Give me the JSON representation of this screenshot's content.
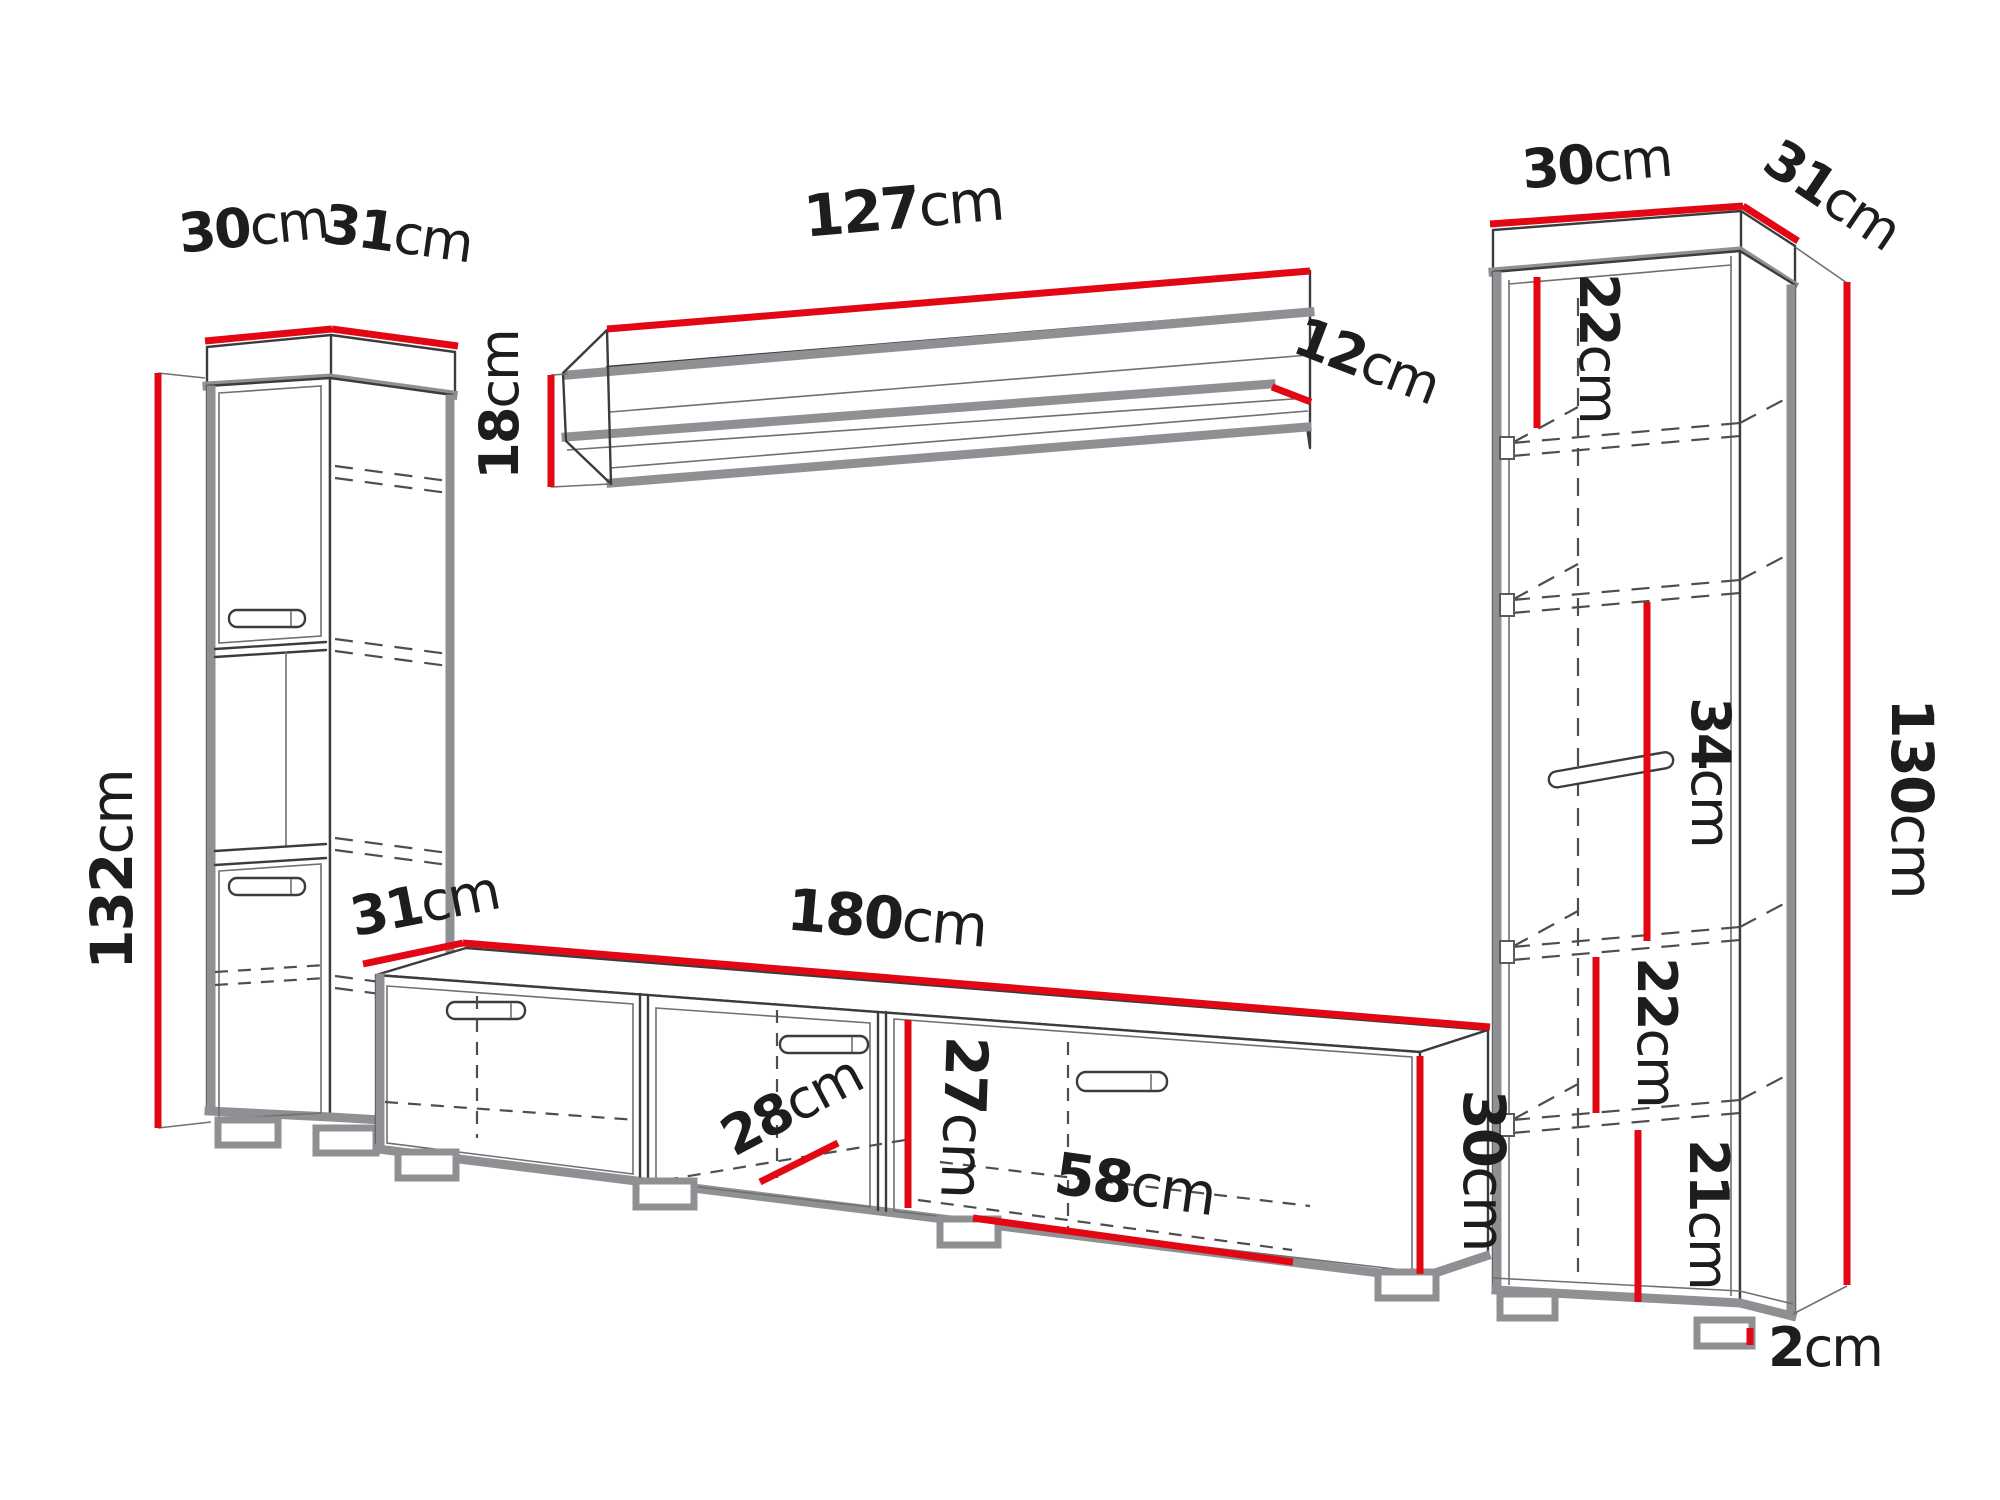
{
  "diagram": {
    "title": "wall-unit furniture dimension diagram",
    "unit": "cm",
    "colors": {
      "dimension_line": "#e30613",
      "edge_gray": "#8f9093",
      "outline": "#3c3c3c",
      "text": "#1d1d1b",
      "background": "#ffffff"
    },
    "left_cabinet": {
      "width": {
        "value": "30",
        "unit": "cm"
      },
      "depth": {
        "value": "31",
        "unit": "cm"
      },
      "height": {
        "value": "132",
        "unit": "cm"
      }
    },
    "wall_shelf": {
      "width": {
        "value": "127",
        "unit": "cm"
      },
      "height": {
        "value": "18",
        "unit": "cm"
      },
      "depth": {
        "value": "12",
        "unit": "cm"
      }
    },
    "right_cabinet": {
      "width": {
        "value": "30",
        "unit": "cm"
      },
      "depth": {
        "value": "31",
        "unit": "cm"
      },
      "height": {
        "value": "130",
        "unit": "cm"
      },
      "section_top": {
        "value": "22",
        "unit": "cm"
      },
      "section_middle": {
        "value": "34",
        "unit": "cm"
      },
      "section_lower": {
        "value": "22",
        "unit": "cm"
      },
      "section_bottom": {
        "value": "21",
        "unit": "cm"
      },
      "foot_height": {
        "value": "2",
        "unit": "cm"
      }
    },
    "tv_stand": {
      "width": {
        "value": "180",
        "unit": "cm"
      },
      "depth": {
        "value": "31",
        "unit": "cm"
      },
      "height": {
        "value": "30",
        "unit": "cm"
      },
      "interior_height": {
        "value": "27",
        "unit": "cm"
      },
      "interior_depth": {
        "value": "28",
        "unit": "cm"
      },
      "compartment_width": {
        "value": "58",
        "unit": "cm"
      }
    }
  }
}
